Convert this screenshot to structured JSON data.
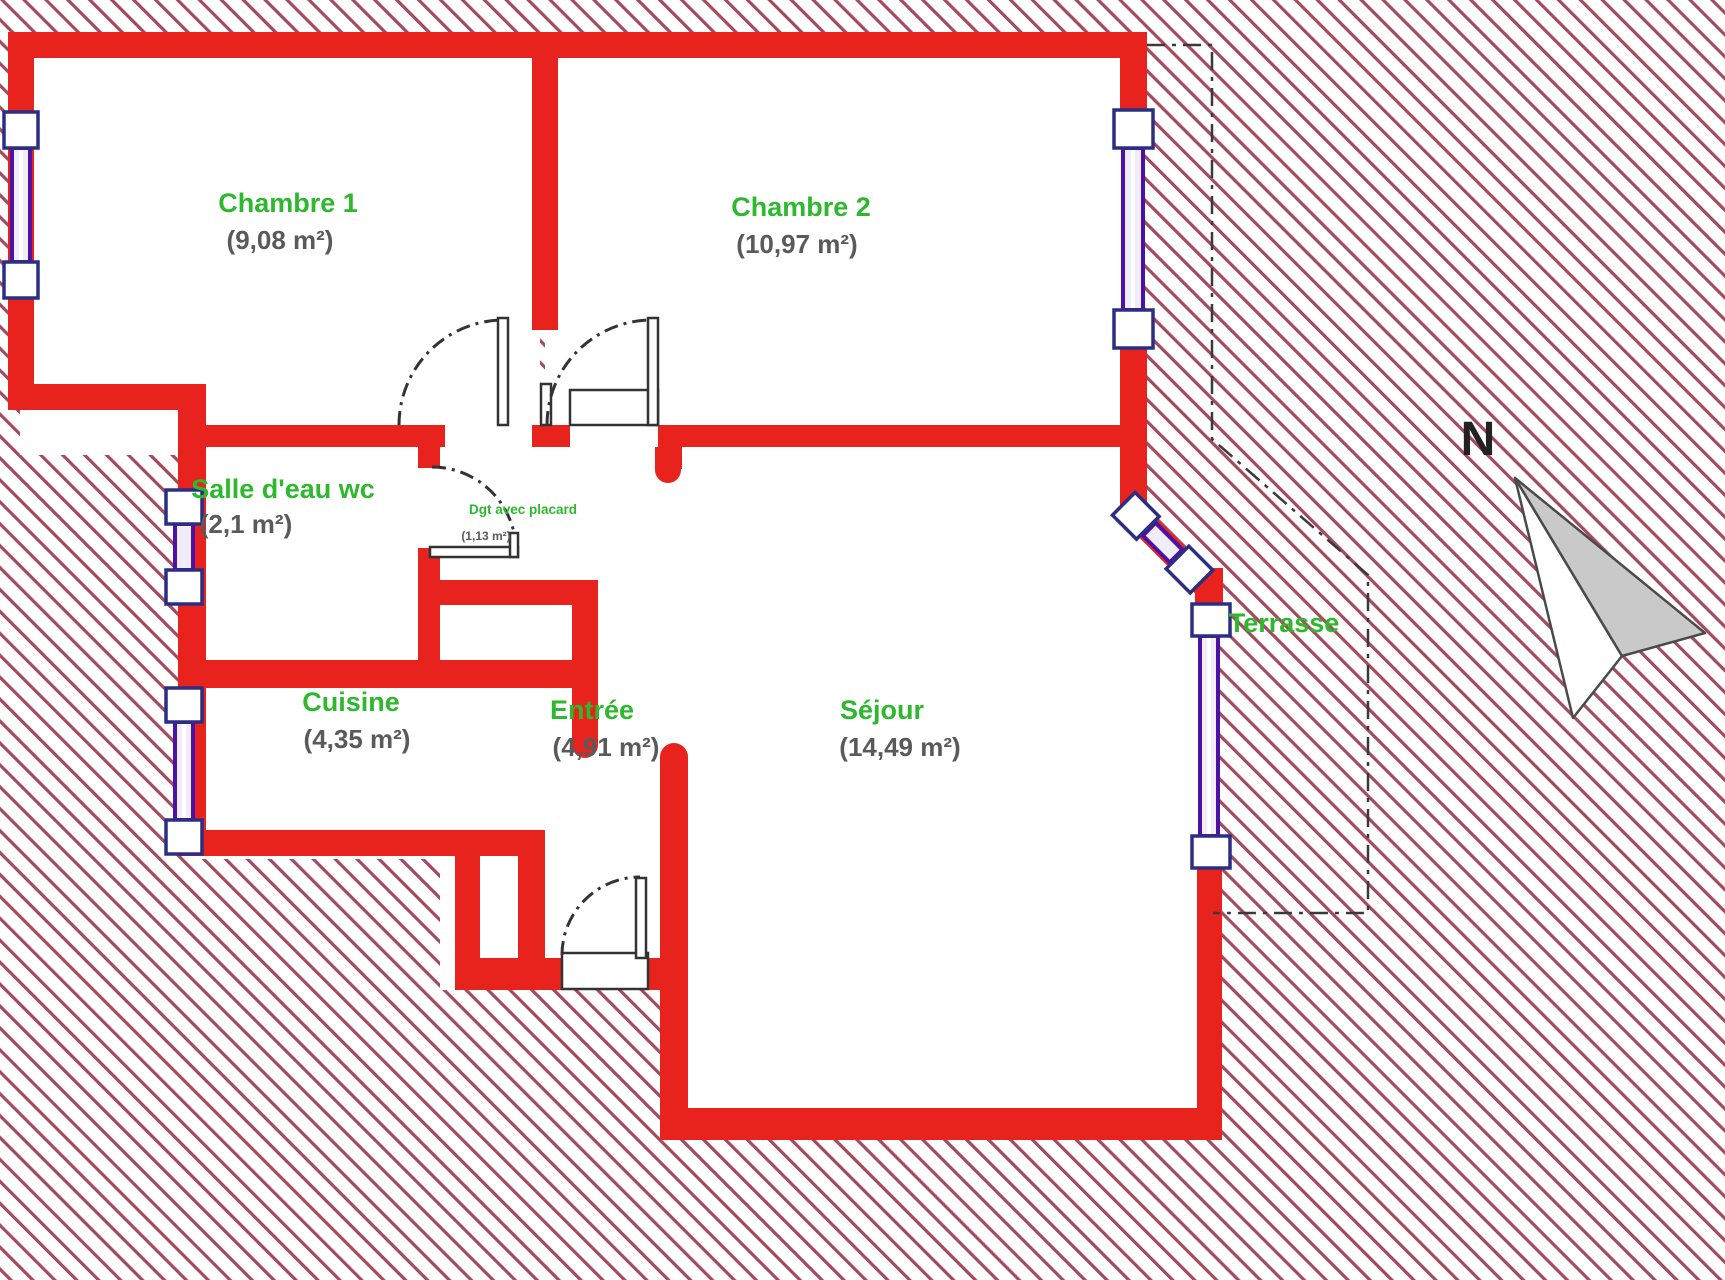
{
  "title": "Plan d'appartement",
  "colors": {
    "wall": "#e8231d",
    "hatch": "#a34a5f",
    "room_label": "#2eb82e",
    "area_label": "#5a5a5a",
    "window": "#4c11a5",
    "window_box_border": "#2b2e83",
    "door": "#333333",
    "boundary": "#3a3a3a",
    "compass_fill": "#c9c9c9",
    "compass_stroke": "#4a4a4a"
  },
  "compass": {
    "north_label": "N"
  },
  "rooms": [
    {
      "id": "chambre1",
      "name": "Chambre 1",
      "area": "(9,08 m²)"
    },
    {
      "id": "chambre2",
      "name": "Chambre 2",
      "area": "(10,97 m²)"
    },
    {
      "id": "salle_deau",
      "name": "Salle d'eau wc",
      "area": "(2,1 m²)"
    },
    {
      "id": "degagement",
      "name": "Dgt avec placard",
      "area": "(1,13 m²)"
    },
    {
      "id": "cuisine",
      "name": "Cuisine",
      "area": "(4,35 m²)"
    },
    {
      "id": "entree",
      "name": "Entrée",
      "area": "(4,91 m²)"
    },
    {
      "id": "sejour",
      "name": "Séjour",
      "area": "(14,49 m²)"
    },
    {
      "id": "terrasse",
      "name": "Terrasse",
      "area": ""
    }
  ]
}
